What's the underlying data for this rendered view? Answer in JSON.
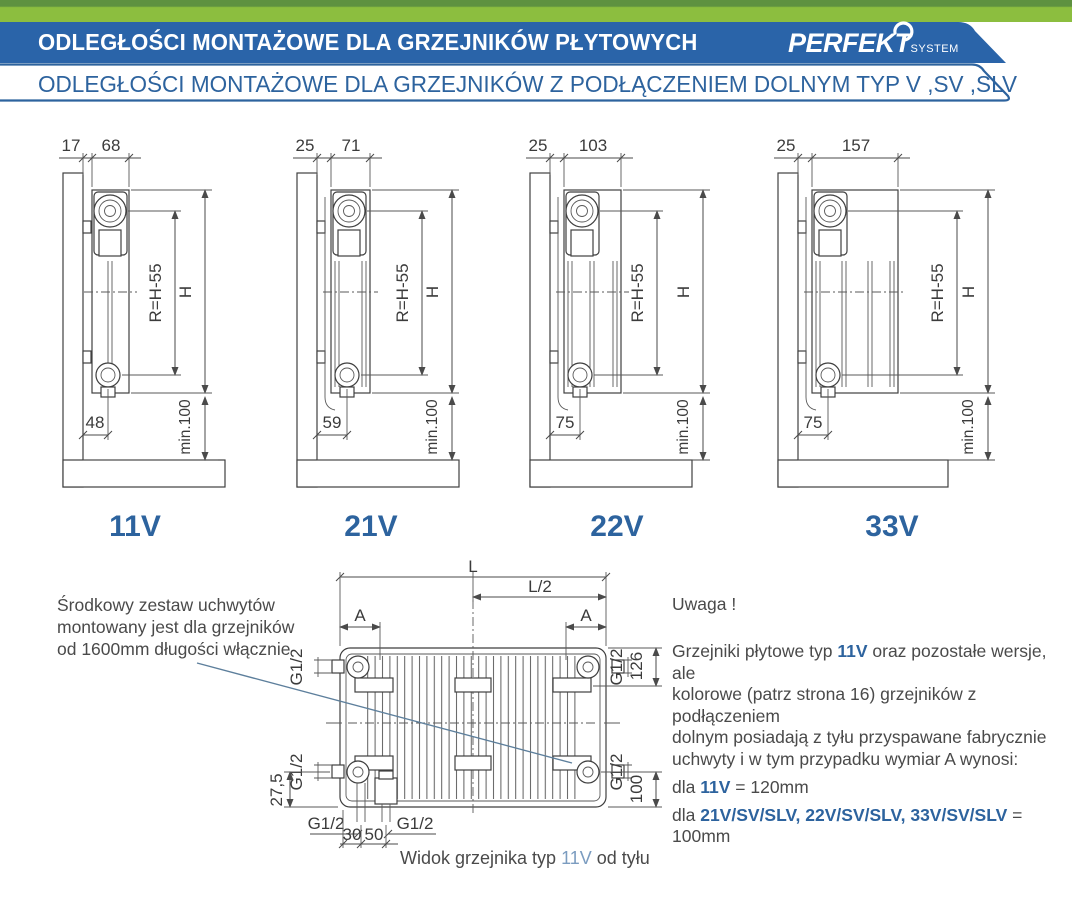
{
  "header": {
    "title": "ODLEGŁOŚCI  MONTAŻOWE  DLA GRZEJNIKÓW  PŁYTOWYCH",
    "brand": "PERFEKT",
    "brand_sub": "SYSTEM",
    "subtitle": "ODLEGŁOŚCI MONTAŻOWE DLA GRZEJNIKÓW Z PODŁĄCZENIEM DOLNYM TYP V ,SV ,SLV",
    "colors": {
      "green": "#8cbe3f",
      "banner_blue": "#2a64a9",
      "accent_blue": "#2d639e"
    }
  },
  "diagrams": [
    {
      "label": "11V",
      "dim_wall": "17",
      "dim_depth": "68",
      "dim_bottom": "48",
      "dim_r": "R=H-55",
      "dim_h": "H",
      "dim_min": "min.100"
    },
    {
      "label": "21V",
      "dim_wall": "25",
      "dim_depth": "71",
      "dim_bottom": "59",
      "dim_r": "R=H-55",
      "dim_h": "H",
      "dim_min": "min.100"
    },
    {
      "label": "22V",
      "dim_wall": "25",
      "dim_depth": "103",
      "dim_bottom": "75",
      "dim_r": "R=H-55",
      "dim_h": "H",
      "dim_min": "min.100"
    },
    {
      "label": "33V",
      "dim_wall": "25",
      "dim_depth": "157",
      "dim_bottom": "75",
      "dim_r": "R=H-55",
      "dim_h": "H",
      "dim_min": "min.100"
    }
  ],
  "rear_view": {
    "dim_l": "L",
    "dim_l2": "L/2",
    "dim_a_left": "A",
    "dim_a_right": "A",
    "g12_top_left": "G1/2",
    "g12_bottom_left": "G1/2",
    "g12_top_right": "G1/2",
    "g12_bottom_right": "G1/2",
    "g12_pipe_left": "G1/2",
    "g12_pipe_right": "G1/2",
    "dim_126": "126",
    "dim_100": "100",
    "dim_27_5": "27,5",
    "dim_30": "30",
    "dim_50": "50",
    "caption_prefix": "Widok grzejnika typ ",
    "caption_type": "11V",
    "caption_suffix": " od tyłu"
  },
  "notes": {
    "left_line1": "Środkowy zestaw uchwytów",
    "left_line2": "montowany jest dla grzejników",
    "left_line3": "od 1600mm długości włącznie",
    "right": {
      "heading": "Uwaga !",
      "p1_pre": "Grzejniki płytowe typ ",
      "p1_hl": "11V",
      "p1_post": " oraz pozostałe wersje, ale",
      "p2": "kolorowe (patrz strona 16) grzejników z podłączeniem",
      "p3": "dolnym posiadają z tyłu przyspawane fabrycznie",
      "p4": "uchwyty i w tym przypadku wymiar A wynosi:",
      "dla1_pre": "dla ",
      "dla1_hl": "11V",
      "dla1_post": " = 120mm",
      "dla2_pre": "dla ",
      "dla2_hl": "21V/SV/SLV, 22V/SV/SLV, 33V/SV/SLV",
      "dla2_post": " = 100mm"
    }
  }
}
